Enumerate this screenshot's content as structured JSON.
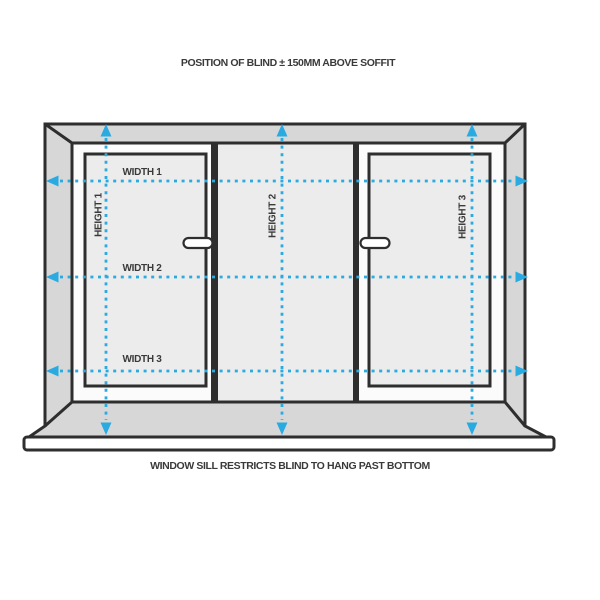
{
  "diagram": {
    "top_note": "POSITION OF BLIND ± 150MM ABOVE SOFFIT",
    "bottom_note": "WINDOW SILL RESTRICTS BLIND TO HANG PAST BOTTOM",
    "labels": {
      "width_1": "WIDTH 1",
      "width_2": "WIDTH 2",
      "width_3": "WIDTH 3",
      "height_1": "HEIGHT 1",
      "height_2": "HEIGHT 2",
      "height_3": "HEIGHT 3"
    },
    "colors": {
      "accent": "#29abe2",
      "outline": "#2e2e2e",
      "reveal_gray": "#d7d7d7",
      "glass": "#ececec",
      "frame_white": "#fbfbfb",
      "text": "#3a3a3a"
    }
  }
}
